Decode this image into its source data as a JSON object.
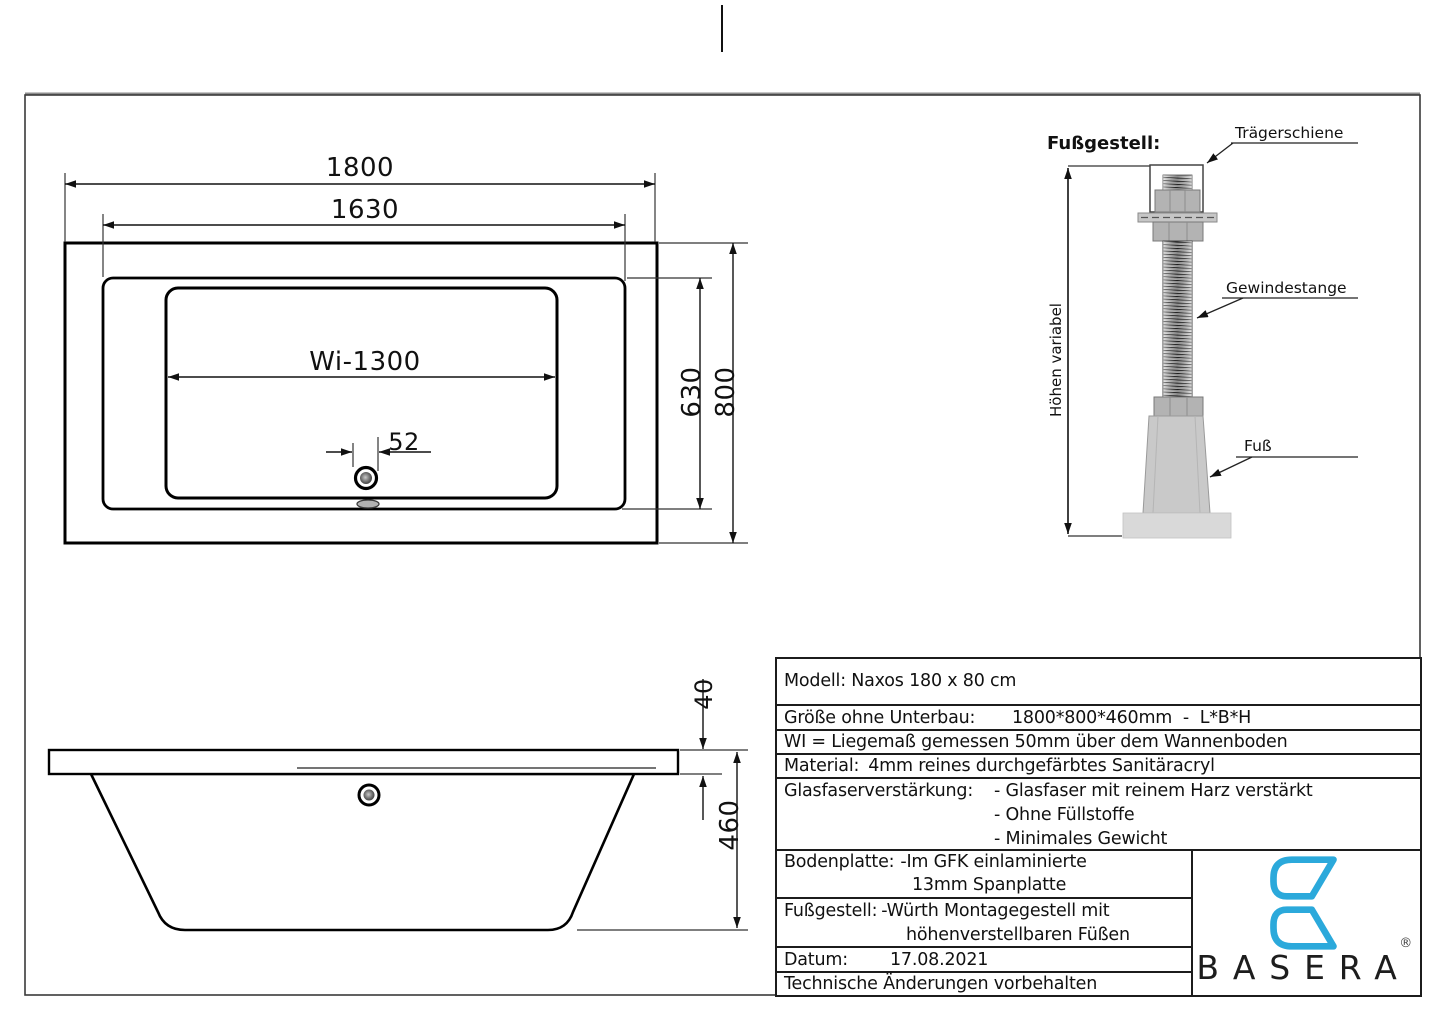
{
  "plan_view": {
    "dim_outer_length": "1800",
    "dim_rim_length": "1630",
    "dim_interior_length": "Wi-1300",
    "dim_drain_offset": "52",
    "dim_rim_width": "630",
    "dim_outer_width": "800"
  },
  "side_view": {
    "dim_rim_height": "40",
    "dim_total_height": "460"
  },
  "foot_assembly": {
    "title": "Fußgestell:",
    "height_dim_label": "Höhen variabel",
    "label_rail": "Trägerschiene",
    "label_threaded_rod": "Gewindestange",
    "label_foot": "Fuß"
  },
  "title_block": {
    "model": "Modell: Naxos 180 x 80 cm",
    "size_label": "Größe ohne Unterbau:",
    "size_value": "1800*800*460mm  -  L*B*H",
    "wi_note": "WI = Liegemaß gemessen 50mm über dem Wannenboden",
    "material_label": "Material:",
    "material_value": "4mm reines durchgefärbtes Sanitäracryl",
    "fiberglass_label": "Glasfaserverstärkung:",
    "fiberglass_items": [
      "- Glasfaser mit reinem Harz verstärkt",
      "- Ohne Füllstoffe",
      "- Minimales Gewicht"
    ],
    "baseplate_label": "Bodenplatte:",
    "baseplate_line1": "-Im GFK einlaminierte",
    "baseplate_line2": "13mm Spanplatte",
    "footframe_label": "Fußgestell:",
    "footframe_line1": "-Würth Montagegestell mit",
    "footframe_line2": "höhenverstellbaren Füßen",
    "date_label": "Datum:",
    "date_value": "17.08.2021",
    "disclaimer": "Technische Änderungen vorbehalten"
  },
  "logo": {
    "brand": "BASERA",
    "registered": "®",
    "accent_color": "#2BA9DB"
  }
}
